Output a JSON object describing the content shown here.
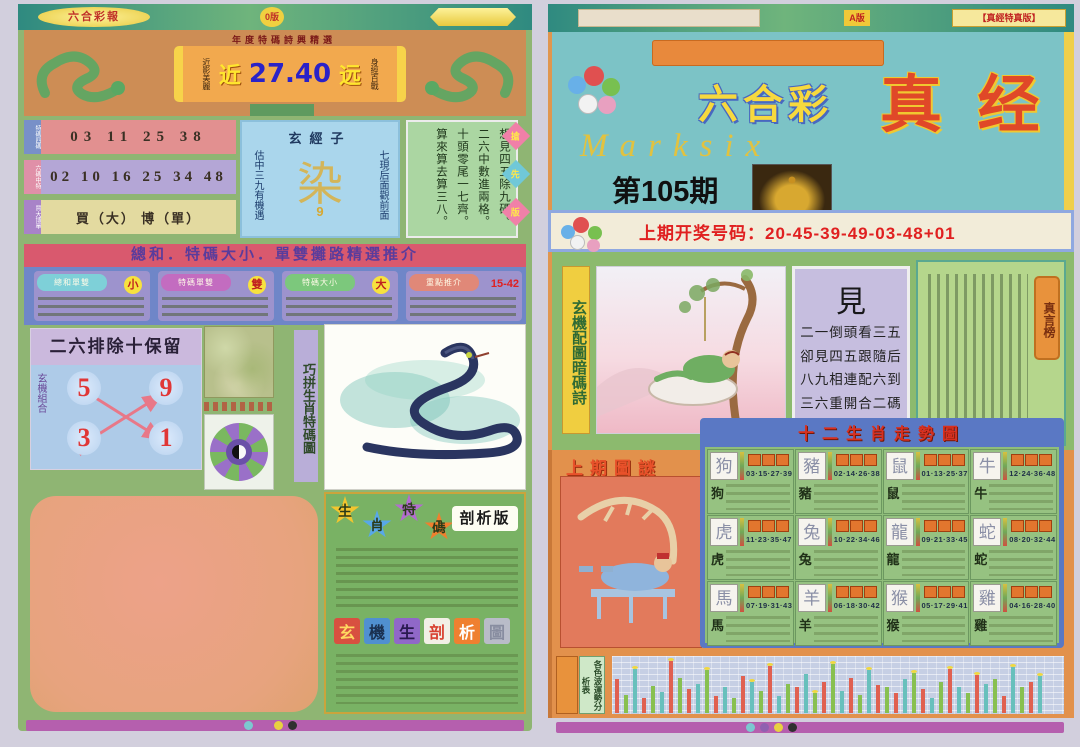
{
  "left": {
    "topbar": {
      "brand": "六合彩報",
      "edition": "0版"
    },
    "header": {
      "tagline": "年度特碼詩興精選",
      "near_label": "近",
      "odds_value": "27.40",
      "far_label": "远",
      "left_note": "近影美麗",
      "right_note": "身經百戰"
    },
    "rows": [
      {
        "label": "特碼四碼",
        "numbers": "03  11  25  38"
      },
      {
        "label": "六碼中特",
        "numbers": "02 10 16 25 34 48"
      },
      {
        "label": "買大博單",
        "numbers": "買（大）  博（單）"
      }
    ],
    "mystic": {
      "title": "玄經子",
      "left_note": "估中三九有機遇",
      "right_note": "七現后面觀前面",
      "big_char": "染",
      "sub_char": "9"
    },
    "poem": [
      "想見四五除九碼。",
      "二六中數進兩格。",
      "十頭零尾一七齊。",
      "算來算去算三八。"
    ],
    "side_tags": [
      "搶",
      "先",
      "版"
    ],
    "banner": "總和．特碼大小．單雙攤路精選推介",
    "recos": [
      {
        "label": "總和單雙",
        "value": "小",
        "pill": "#7ed0d8"
      },
      {
        "label": "特碼單雙",
        "value": "雙",
        "pill": "#c36cc0"
      },
      {
        "label": "特碼大小",
        "value": "大",
        "pill": "#7cc87c"
      },
      {
        "label": "重點推介",
        "value": "15-42",
        "pill": "#e08878"
      }
    ],
    "exclude": {
      "title": "二六排除十保留",
      "side_label": "玄機組合",
      "n1": "5",
      "n2": "9",
      "n3": "3",
      "n4": "1"
    },
    "strip_label": "巧拼生肖特碼圖",
    "analysis": {
      "stars": [
        {
          "char": "生",
          "color": "#f2c52e"
        },
        {
          "char": "肖",
          "color": "#58a8e8"
        },
        {
          "char": "特",
          "color": "#b36cd0"
        },
        {
          "char": "碼",
          "color": "#ef7f2e"
        }
      ],
      "edition_tag": "剖析版",
      "squares": [
        {
          "char": "玄",
          "bg": "#d85040",
          "fg": "#ffd860"
        },
        {
          "char": "機",
          "bg": "#5090d0",
          "fg": "#1a3050"
        },
        {
          "char": "生",
          "bg": "#9068c8",
          "fg": "#2a1a50"
        },
        {
          "char": "剖",
          "bg": "#f2efe6",
          "fg": "#d84030"
        },
        {
          "char": "析",
          "bg": "#ef8030",
          "fg": "#ffffff"
        },
        {
          "char": "圖",
          "bg": "#b9bcc8",
          "fg": "#888da0"
        }
      ]
    }
  },
  "right": {
    "topbar": {
      "center_tag": "A版",
      "right_tag": "【真經特真版】"
    },
    "masthead": {
      "title_cn": "六合彩",
      "title_big": "真 经",
      "title_en": "Marksix",
      "issue": "第105期"
    },
    "last_draw": "上期开奖号码：20-45-39-49-03-48+01",
    "strip_label": "玄機配圖暗碼詩",
    "riddle": {
      "big_char": "見",
      "lines": [
        "二一倒頭看三五",
        "卻見四五跟隨后",
        "八九相連配六到",
        "三六重開合二碼"
      ]
    },
    "board_tag": "真言榜",
    "last_puzzle_label": "上期圖謎",
    "zodiac": {
      "title": "十二生肖走勢圖",
      "cards": [
        {
          "name": "狗",
          "nums": "03·15·27·39"
        },
        {
          "name": "豬",
          "nums": "02·14·26·38"
        },
        {
          "name": "鼠",
          "nums": "01·13·25·37"
        },
        {
          "name": "牛",
          "nums": "12·24·36·48"
        },
        {
          "name": "虎",
          "nums": "11·23·35·47"
        },
        {
          "name": "兔",
          "nums": "10·22·34·46"
        },
        {
          "name": "龍",
          "nums": "09·21·33·45"
        },
        {
          "name": "蛇",
          "nums": "08·20·32·44"
        },
        {
          "name": "馬",
          "nums": "07·19·31·43"
        },
        {
          "name": "羊",
          "nums": "06·18·30·42"
        },
        {
          "name": "猴",
          "nums": "05·17·29·41"
        },
        {
          "name": "雞",
          "nums": "04·16·28·40"
        }
      ]
    },
    "wave_label": "各色波運勢分析表"
  },
  "chart_data": {
    "type": "bar",
    "title": "各色波運勢分析表",
    "xlabel": "",
    "ylabel": "",
    "legend": [
      "红波",
      "绿波",
      "蓝波"
    ],
    "colors": {
      "r": "#e06050",
      "g": "#88c050",
      "c": "#68c0bc"
    },
    "grid": true,
    "ylim": [
      0,
      100
    ],
    "bars": [
      {
        "h": 60,
        "c": "r"
      },
      {
        "h": 32,
        "c": "g"
      },
      {
        "h": 78,
        "c": "c",
        "tip": true
      },
      {
        "h": 26,
        "c": "r"
      },
      {
        "h": 48,
        "c": "g"
      },
      {
        "h": 38,
        "c": "c"
      },
      {
        "h": 92,
        "c": "r",
        "tip": true
      },
      {
        "h": 62,
        "c": "g"
      },
      {
        "h": 42,
        "c": "r"
      },
      {
        "h": 52,
        "c": "c"
      },
      {
        "h": 76,
        "c": "g",
        "tip": true
      },
      {
        "h": 30,
        "c": "r"
      },
      {
        "h": 46,
        "c": "c"
      },
      {
        "h": 26,
        "c": "g"
      },
      {
        "h": 66,
        "c": "r"
      },
      {
        "h": 56,
        "c": "c",
        "tip": true
      },
      {
        "h": 40,
        "c": "g"
      },
      {
        "h": 84,
        "c": "r",
        "tip": true
      },
      {
        "h": 30,
        "c": "c"
      },
      {
        "h": 52,
        "c": "g"
      },
      {
        "h": 46,
        "c": "r"
      },
      {
        "h": 70,
        "c": "c"
      },
      {
        "h": 36,
        "c": "g",
        "tip": true
      },
      {
        "h": 56,
        "c": "r"
      },
      {
        "h": 88,
        "c": "g",
        "tip": true
      },
      {
        "h": 40,
        "c": "c"
      },
      {
        "h": 62,
        "c": "r"
      },
      {
        "h": 32,
        "c": "g"
      },
      {
        "h": 76,
        "c": "c",
        "tip": true
      },
      {
        "h": 50,
        "c": "r"
      },
      {
        "h": 46,
        "c": "g"
      },
      {
        "h": 36,
        "c": "r"
      },
      {
        "h": 60,
        "c": "c"
      },
      {
        "h": 72,
        "c": "g",
        "tip": true
      },
      {
        "h": 42,
        "c": "r"
      },
      {
        "h": 26,
        "c": "c"
      },
      {
        "h": 56,
        "c": "g"
      },
      {
        "h": 78,
        "c": "r",
        "tip": true
      },
      {
        "h": 46,
        "c": "c"
      },
      {
        "h": 36,
        "c": "g"
      },
      {
        "h": 68,
        "c": "r",
        "tip": true
      },
      {
        "h": 52,
        "c": "c"
      },
      {
        "h": 60,
        "c": "g"
      },
      {
        "h": 30,
        "c": "r"
      },
      {
        "h": 82,
        "c": "c",
        "tip": true
      },
      {
        "h": 46,
        "c": "g"
      },
      {
        "h": 56,
        "c": "r"
      },
      {
        "h": 66,
        "c": "c",
        "tip": true
      }
    ]
  }
}
